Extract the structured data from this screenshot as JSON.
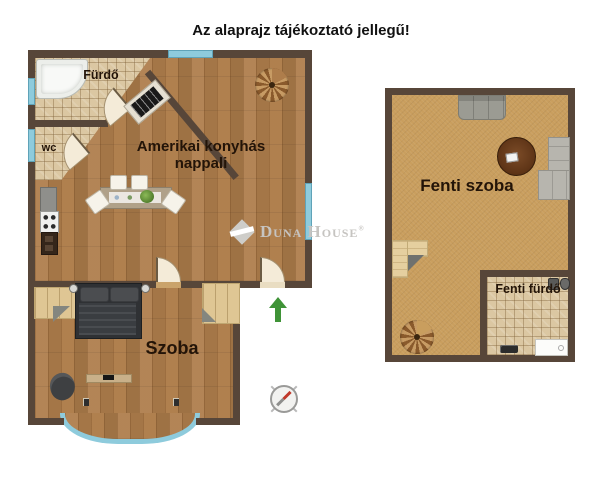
{
  "title": "Az alaprajz tájékoztató jellegű!",
  "watermark": {
    "word1": "Duna",
    "word2": "House",
    "registered": "®"
  },
  "ground_floor": {
    "labels": {
      "bathroom": "Fürdő",
      "wc": "wc",
      "living": "Amerikai konyhás nappali",
      "bedroom": "Szoba"
    }
  },
  "upper_floor": {
    "labels": {
      "room": "Fenti szoba",
      "bathroom": "Fenti fürdő"
    }
  },
  "icons": {
    "entrance_arrow": "green-up-arrow",
    "compass": "compass-rose-with-red-needle",
    "spiral_stairs": "spiral-staircase",
    "door": "quarter-circle-door-swing",
    "watermark_logo": "duna-house-diamond"
  },
  "colors": {
    "wall": "#574639",
    "wood_floor": "#ae7d4b",
    "tile_floor": "#dbc7a2",
    "sand_floor": "#c99e5e",
    "window": "#8ecbdc",
    "window_border": "#5fa3b8",
    "label_text": "#231408",
    "title_text": "#111111",
    "watermark": "#c6c4c1",
    "arrow_green": "#3f9337",
    "compass_needle": "#c0392b"
  }
}
